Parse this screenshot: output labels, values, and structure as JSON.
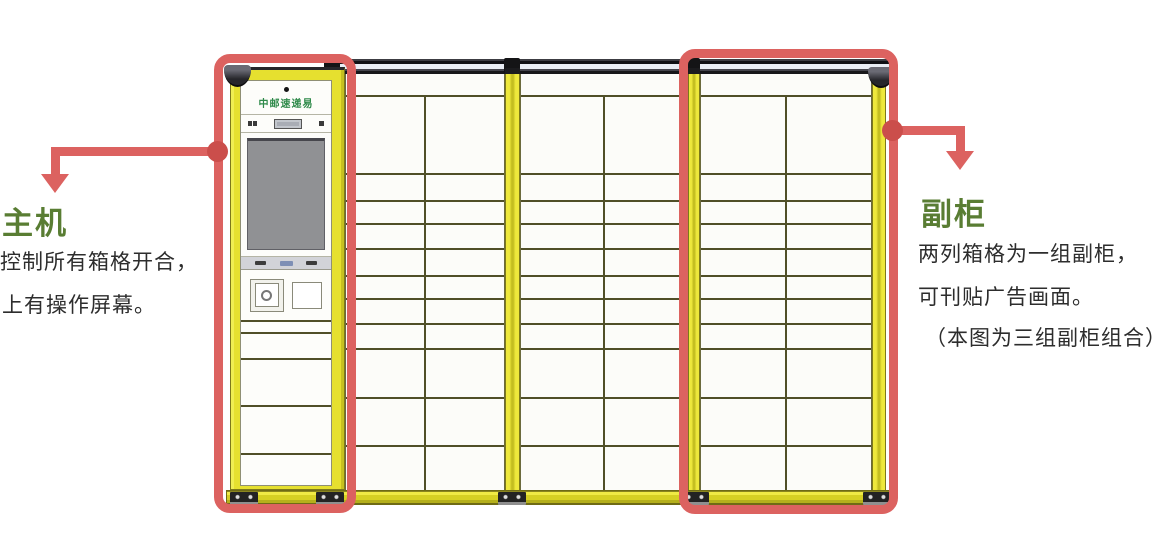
{
  "annotations": {
    "main_unit": {
      "title": "主机",
      "lines": [
        "控制所有箱格开合，",
        "上有操作屏幕。"
      ]
    },
    "aux_cabinet": {
      "title": "副柜",
      "lines": [
        "两列箱格为一组副柜，",
        "可刊贴广告画面。",
        "（本图为三组副柜组合）"
      ]
    }
  },
  "cabinet": {
    "brand": "中邮速递易",
    "sections": 3,
    "columns_per_section": 2,
    "locker_rows": {
      "top_spacer": 21,
      "heights": [
        78,
        27,
        23,
        25,
        27,
        23,
        25,
        25,
        49,
        48,
        45
      ]
    },
    "main_unit": {
      "lower_doors": [
        26,
        47,
        48,
        48
      ]
    }
  },
  "colors": {
    "label_green": "#597d33",
    "body_text": "#2d2d2d",
    "annotation_red": "#dc6260",
    "connector_red": "#cb4e4b",
    "frame_yellow": "#e6e02f",
    "frame_edge": "#7d781b",
    "grid_line": "#504f28",
    "box_white": "#fcfcf9",
    "topbar_black": "#17171a",
    "screen_gray": "#909194",
    "panel_gray": "#d2d3d8",
    "brand_green": "#2f8a4a"
  }
}
